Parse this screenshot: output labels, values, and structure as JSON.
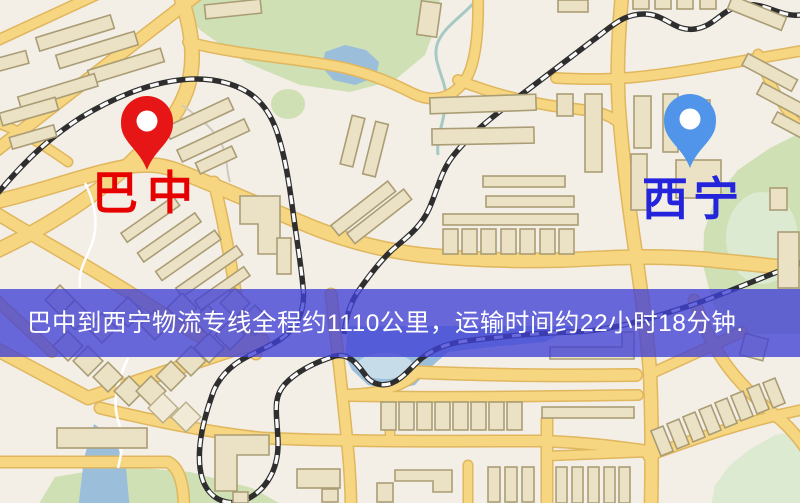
{
  "map": {
    "origin_marker": {
      "label": "巴中",
      "pin_color": "#ee1414",
      "label_color": "#e60000",
      "icon": "map-pin-icon"
    },
    "destination_marker": {
      "label": "西宁",
      "pin_color": "#4f95ef",
      "label_color": "#2424dd",
      "icon": "map-pin-icon"
    },
    "info_banner": {
      "text": "巴中到西宁物流专线全程约1110公里，运输时间约22小时18分钟.",
      "background_color": "#4040d6",
      "text_color": "#ffffff"
    },
    "route": {
      "from": "巴中",
      "to": "西宁",
      "distance_text": "约1110公里",
      "duration_text": "约22小时18分钟"
    },
    "palette": {
      "land": "#f3efe6",
      "road_fill": "#f7d67c",
      "road_casing": "#e2b65a",
      "park": "#cfe0b4",
      "park_light": "#dcead0",
      "water": "#9abfdc",
      "building_fill": "#ebe2c4",
      "building_outline": "#ab9d74",
      "railway_dark": "#2e2e2e",
      "railway_light": "#fafafa"
    }
  }
}
